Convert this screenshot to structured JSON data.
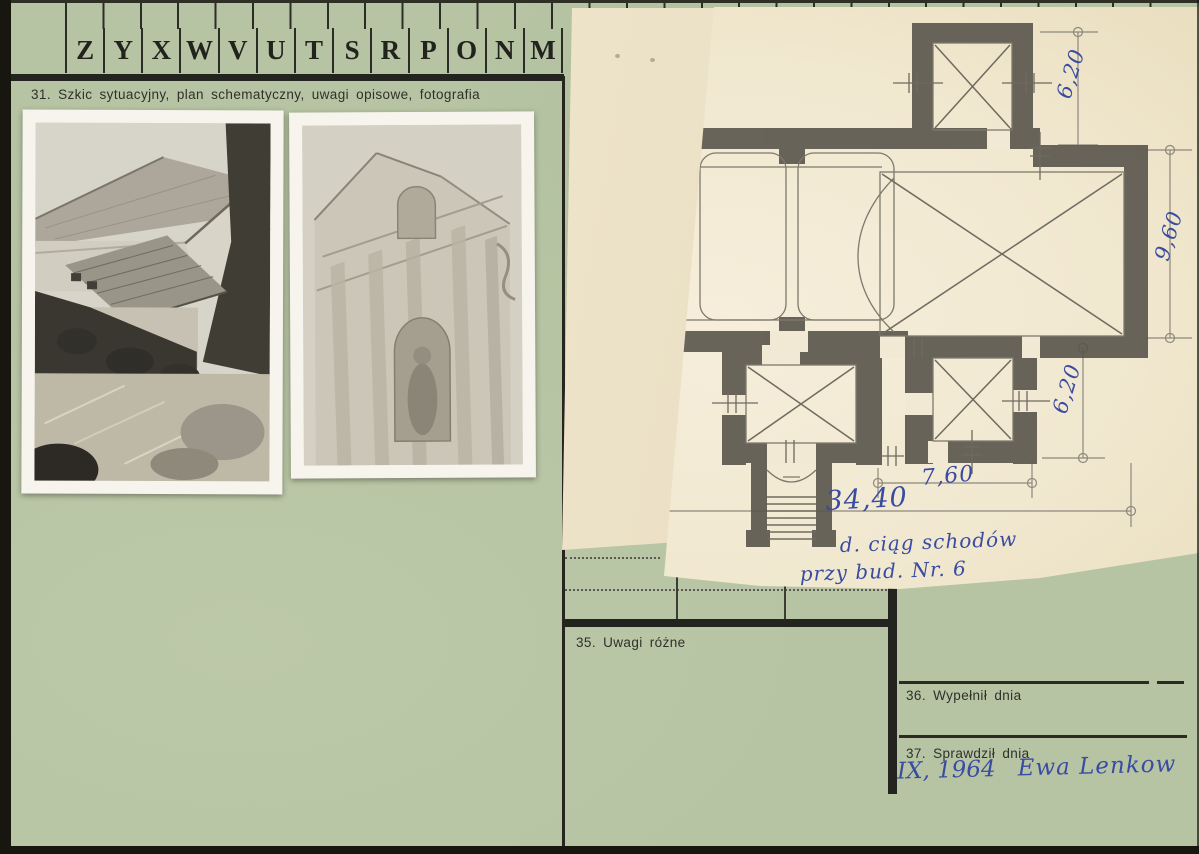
{
  "tabs": [
    "Z",
    "Y",
    "X",
    "W",
    "V",
    "U",
    "T",
    "S",
    "R",
    "P",
    "O",
    "N",
    "M"
  ],
  "sections": {
    "s31": "31. Szkic sytuacyjny, plan schematyczny, uwagi opisowe, fotografia",
    "s35": "35. Uwagi różne",
    "s36": "36. Wypełnił dnia",
    "s37": "37. Sprawdził dnia"
  },
  "plan": {
    "dimensions": {
      "tower_depth": "6,20",
      "chancel_width": "9,60",
      "chapel_depth": "6,20",
      "chapel_width": "7,60",
      "total_length": "34,40"
    },
    "note_line1": "d. ciąg schodów",
    "note_line2": "przy bud. Nr. 6"
  },
  "handwritten": {
    "date": "IX, 1964",
    "signature": "Ewa Lenkow"
  },
  "colors": {
    "card_green": "#b6c4a3",
    "paper_cream": "#f1e8d0",
    "paper_under": "#e9dec0",
    "ink_blue": "#3a4ca1",
    "print_black": "#26261f",
    "pencil_wall": "#59554c"
  }
}
